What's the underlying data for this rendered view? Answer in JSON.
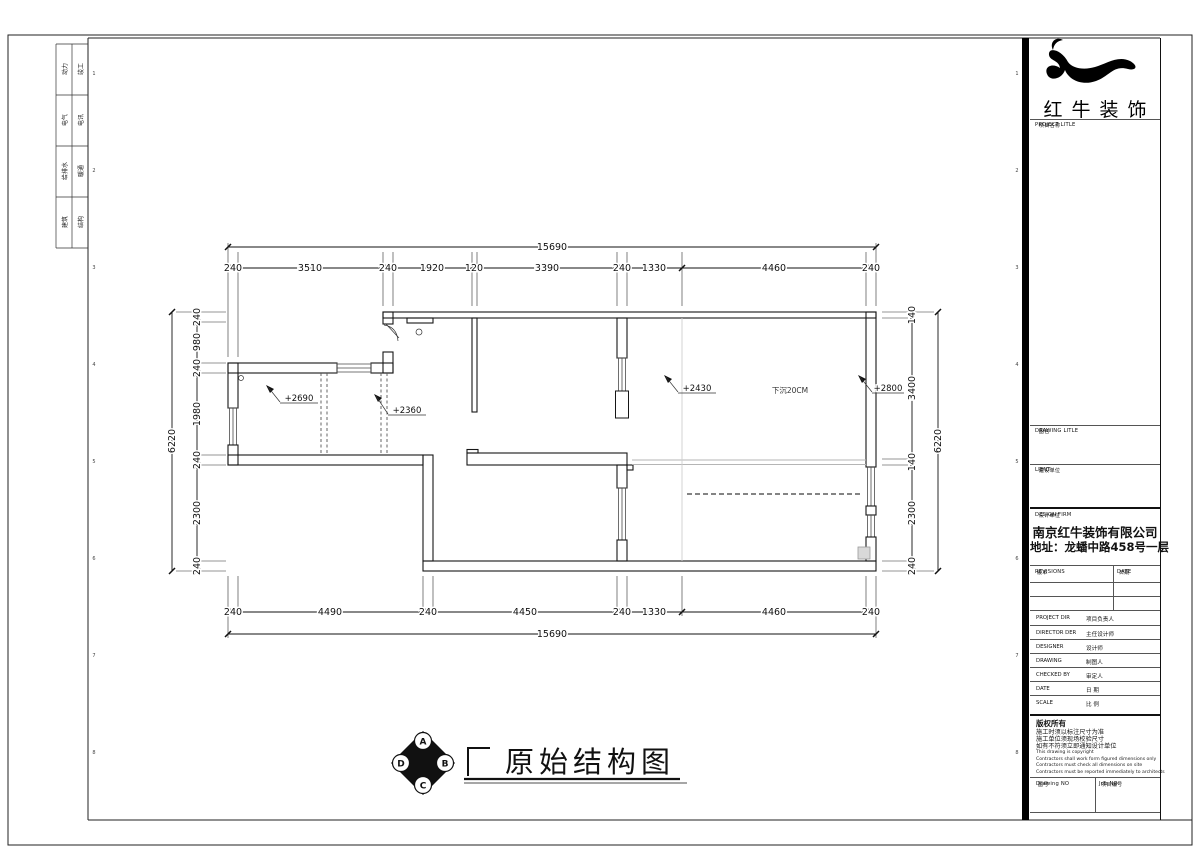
{
  "sheet": {
    "binding_strip": {
      "rows": [
        [
          "动力",
          "竣工"
        ],
        [
          "电气",
          "电讯"
        ],
        [
          "给排水",
          "暖通"
        ],
        [
          "建筑",
          "结构"
        ]
      ]
    },
    "fold_marks": [
      "1",
      "2",
      "3",
      "4",
      "5",
      "6",
      "7",
      "8"
    ]
  },
  "title_block": {
    "brand_name": "红牛装饰",
    "project_title_label": "PROJECT LITLE",
    "project_title_cn": "项目名称",
    "drawing_title_label": "DRAWING LITLE",
    "drawing_title_cn": "图名",
    "client_label": "LIENT",
    "client_cn": "建设单位",
    "design_firm_label": "DESIGN FIRM",
    "design_firm_cn": "设计单位",
    "company_name": "南京红牛装饰有限公司",
    "company_address": "地址：龙蟠中路458号一层",
    "revisions_label": "REVISIONS",
    "revisions_cn": "版本",
    "date_label": "DATE",
    "date_cn": "日期",
    "rows": [
      {
        "en": "PROJECT DIR",
        "cn": "项目负责人"
      },
      {
        "en": "DIRECTOR DER",
        "cn": "主任设计师"
      },
      {
        "en": "DESIGNER",
        "cn": "设计师"
      },
      {
        "en": "DRAWING",
        "cn": "制图人"
      },
      {
        "en": "CHECKED BY",
        "cn": "审定人"
      },
      {
        "en": "DATE",
        "cn": "日  期"
      },
      {
        "en": "SCALE",
        "cn": "比  例"
      }
    ],
    "copyright_title": "版权所有",
    "copyright_cn": [
      "施工时须以标注尺寸为准",
      "施工单位须现场校验尺寸",
      "如有不符须立即通知设计单位"
    ],
    "copyright_en": [
      "This drawing is copyright",
      "Contractors shall work form figured dimensions only",
      "Contractors must check all dimensions on site",
      "Contractors must be reported immediately to architects"
    ],
    "drawing_no_label": "Drawing NO",
    "drawing_no_cn": "图号",
    "job_no_label": "Job NO",
    "job_no_cn": "项目编号"
  },
  "drawing": {
    "title": "原始结构图",
    "compass": {
      "n": "A",
      "e": "B",
      "s": "C",
      "w": "D"
    },
    "annotations": {
      "elev_left": "+2690",
      "elev_mid": "+2360",
      "elev_room": "+2430",
      "elev_right": "+2800",
      "note": "下沉20CM"
    },
    "dims": {
      "top_total": "15690",
      "top": [
        "240",
        "3510",
        "240",
        "1920",
        "120",
        "3390",
        "240",
        "1330",
        "4460",
        "240"
      ],
      "bottom": [
        "240",
        "4490",
        "240",
        "4450",
        "240",
        "1330",
        "4460",
        "240"
      ],
      "bottom_total": "15690",
      "left": [
        "240",
        "980",
        "240",
        "1980",
        "240",
        "2300",
        "240"
      ],
      "left_total": "6220",
      "right": [
        "140",
        "3400",
        "140",
        "2300",
        "240"
      ],
      "right_total": "6220"
    }
  }
}
